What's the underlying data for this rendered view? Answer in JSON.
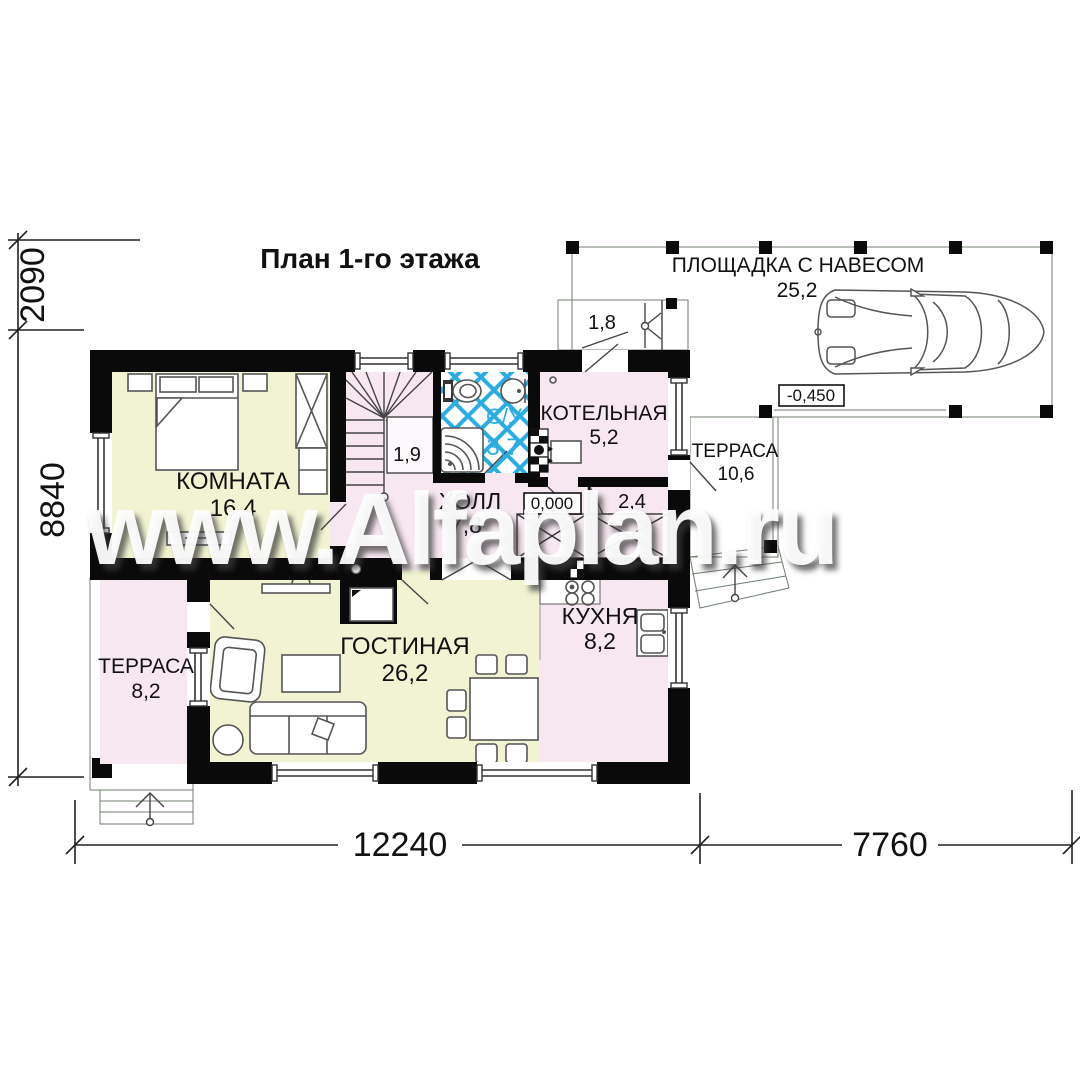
{
  "title": "План 1-го этажа",
  "watermark": "www.Alfaplan.ru",
  "colors": {
    "room_yellow": "#f1f3d2",
    "room_pink": "#f7e7f0",
    "outdoor_green": "#dcead8",
    "tile_blue": "#2aaee2",
    "wall": "#0a0a0a"
  },
  "rooms": {
    "bedroom": {
      "name": "КОМНАТА",
      "area": "16,4"
    },
    "living": {
      "name": "ГОСТИНАЯ",
      "area": "26,2"
    },
    "kitchen": {
      "name": "КУХНЯ",
      "area": "8,2"
    },
    "hall": {
      "name": "ХОЛЛ",
      "area": "7,8"
    },
    "bathroom": {
      "name": "С/У",
      "area": "3,7"
    },
    "boiler": {
      "name": "КОТЕЛЬНАЯ",
      "area": "5,2"
    },
    "terrace_left": {
      "name": "ТЕРРАСА",
      "area": "8,2"
    },
    "terrace_right": {
      "name": "ТЕРРАСА",
      "area": "10,6"
    },
    "canopy": {
      "name": "ПЛОЩАДКА С НАВЕСОМ",
      "area": "25,2"
    },
    "stair_nook": {
      "area": "1,9"
    },
    "porch": {
      "area": "1,8"
    },
    "closet": {
      "area": "2,4"
    }
  },
  "levels": {
    "ground": "0,000",
    "yard": "-0,450"
  },
  "dimensions": {
    "left_top": "2090",
    "left_main": "8840",
    "bottom_main": "12240",
    "bottom_right": "7760"
  }
}
